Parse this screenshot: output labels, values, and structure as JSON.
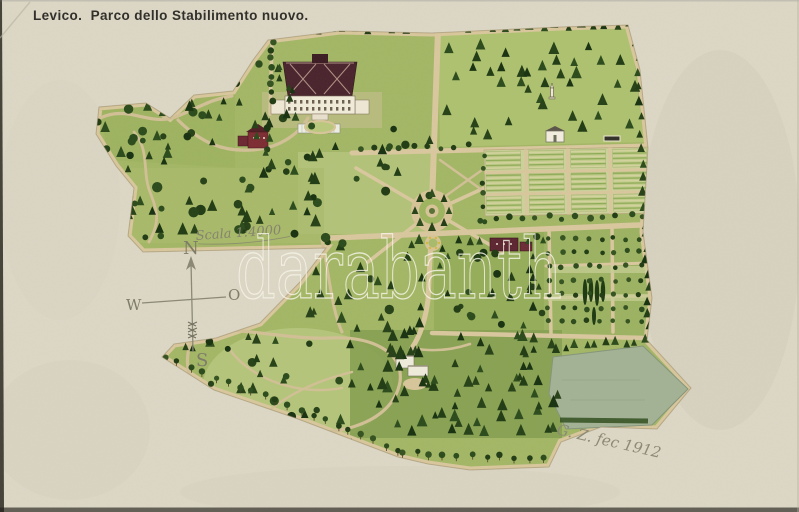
{
  "postcard": {
    "title": "Levico.  Parco dello Stabilimento nuovo.",
    "map": {
      "scale_label": "Scala 1:4000",
      "compass": {
        "north": "N",
        "east": "O",
        "south": "S",
        "west": "W"
      },
      "signature": "G. Z. fec 1912"
    },
    "watermark": "darabanth",
    "colors": {
      "paper": "#ddd8c6",
      "meadow": "#a3b765",
      "trees_dark": "#1f3a12",
      "path_tan": "#d9c79c",
      "roof_maroon": "#48222b",
      "water_meadow": "#a3b295",
      "title_ink": "#2e2c27",
      "pencil": "#84826d",
      "watermark_stroke": "#faf7ec"
    }
  }
}
